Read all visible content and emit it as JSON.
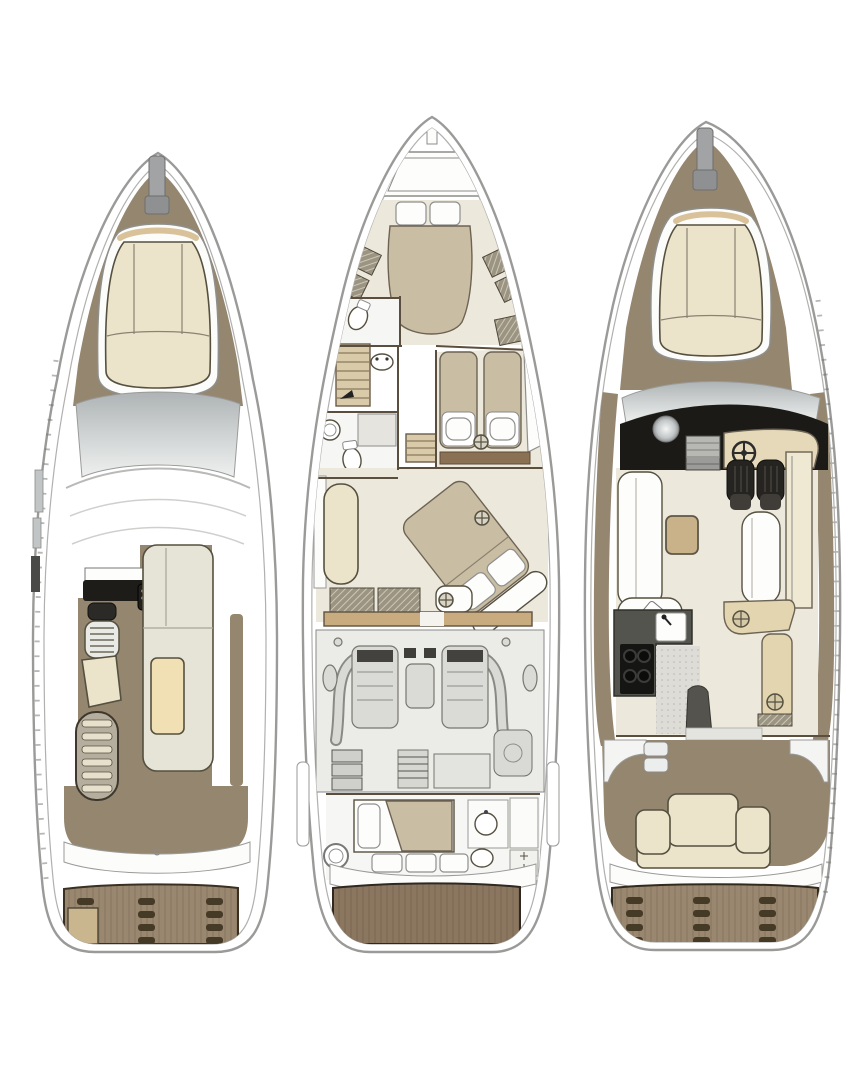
{
  "canvas": {
    "width": 851,
    "height": 1080,
    "background": "#ffffff"
  },
  "palette": {
    "hull_outline": "#9a9a98",
    "ink": "#55503f",
    "wall_brown": "#5a4e3f",
    "deck_brown": "#95866f",
    "platform_brown": "#9a8770",
    "platform_dark": "#8b7660",
    "slot_dark": "#453a26",
    "cushion_cream": "#ece4ca",
    "bench_pale": "#e5e4d6",
    "tan_fabric": "#c9bda3",
    "tan_wood": "#c8ab7f",
    "table_cream": "#f0e0b4",
    "console_black": "#1d1c19",
    "engine_bg": "#ebebe8",
    "machine_gray": "#dadad7",
    "floor_cream": "#ece8db",
    "floor_white": "#f6f6f4",
    "step_tan": "#d9cbaa",
    "glass_dark": "#aeb3b5",
    "glass_light": "#eef0ef"
  },
  "diagram": {
    "type": "yacht-deck-plans",
    "orientation": "bow-up",
    "views": [
      {
        "id": "flybridge-deck",
        "position": "left",
        "features": [
          "bow pulpit",
          "bow sun pad",
          "windshield",
          "hardtop",
          "helm console",
          "helm seat",
          "wet bar grill",
          "sun lounger cushion",
          "l-shaped settee",
          "table",
          "stairs to cockpit",
          "side walkway",
          "aft deck",
          "transom step",
          "swim platform with vents"
        ]
      },
      {
        "id": "lower-deck",
        "position": "center",
        "features": [
          "foredeck hatch",
          "vip cabin island bed",
          "wardrobes",
          "forward head",
          "port stairs",
          "midship head with shower",
          "twin guest cabin",
          "companionway steps",
          "master cabin diagonal island bed",
          "master sofa",
          "chaise bench",
          "wardrobe lockers",
          "engine room with twin engines",
          "exhaust piping",
          "generator",
          "batteries",
          "crew cabin",
          "crew head",
          "swim platform"
        ]
      },
      {
        "id": "main-deck",
        "position": "right",
        "features": [
          "bow pulpit",
          "bow sun pad",
          "windshield",
          "helm station",
          "steering wheel",
          "double helm seats",
          "companionway stairs",
          "salon l-sofa",
          "coffee table",
          "bench",
          "sideboard",
          "galley counter",
          "sink",
          "four-burner stove",
          "stairs down",
          "dinette",
          "cockpit",
          "cockpit steps",
          "aft bench seat",
          "swim platform with vents"
        ]
      }
    ]
  }
}
